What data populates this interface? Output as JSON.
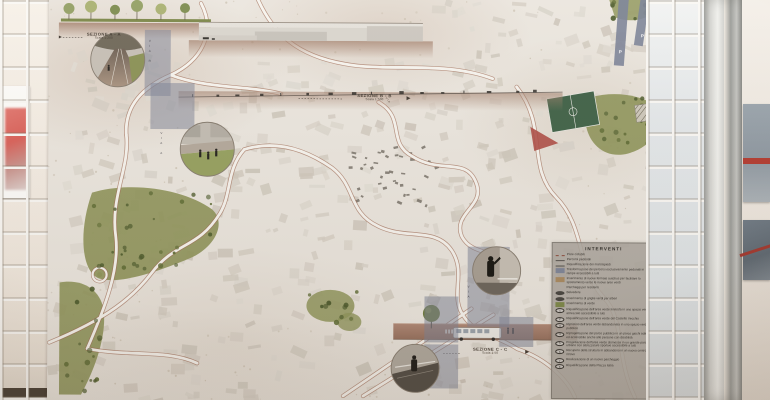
{
  "poster": {
    "sections": {
      "a": {
        "label": "SEZIONE A - A",
        "scale": "Scala 1:200"
      },
      "b": {
        "label": "SEZIONE B - B",
        "scale": "Scala 1:500"
      },
      "c": {
        "label": "SEZIONE C - C",
        "scale": "Scala 1:50"
      }
    },
    "legend": {
      "title": "INTERVENTI",
      "items": [
        {
          "sym": "dash",
          "text": "Piste ciclabili"
        },
        {
          "sym": "line",
          "text": "Percorsi pedonali"
        },
        {
          "sym": "line2",
          "text": "Riqualificazione dei marciapiedi"
        },
        {
          "sym": "sq",
          "text": "Trasformazione dei percorsi esclusivamente pedonali in rampe accessibili a tutti"
        },
        {
          "sym": "sq2",
          "text": "Inserimento di nuove fermate autobus per facilitare lo spostamento verso le nuove aree verdi"
        },
        {
          "sym": "p",
          "text": "Parcheggi per residenti"
        },
        {
          "sym": "dot",
          "text": "Belvedere"
        },
        {
          "sym": "dot",
          "text": "Inserimento di griglie verdi per alberi"
        },
        {
          "sym": "sqg",
          "text": "Inserimento di verde"
        },
        {
          "num": "1",
          "text": "Riqualificazione dell'area verde limitrofa in uno spazio verde attrezzato accessibile a tutti"
        },
        {
          "num": "2",
          "text": "Riqualificazione dell'area verde del Castello Vecchio"
        },
        {
          "num": "3",
          "text": "Ripristino dell'area verde abbandonata in uno spazio verde pubblico"
        },
        {
          "num": "4",
          "text": "Riprogettazione del parco pubblico in un parco giochi adatto ed accessibile anche alle persone con disabilità"
        },
        {
          "num": "5",
          "text": "Progettazione dell'area verde dismessa in un grande parco urbano con attrezzature sportive accessibile a tutti"
        },
        {
          "num": "6",
          "text": "Recupero della struttura in abbandono in un nuovo centro di ritrovo"
        },
        {
          "num": "7",
          "text": "Realizzazione di un nuovo parcheggio"
        },
        {
          "num": "8",
          "text": "Riqualificazione della Piazza Italia"
        }
      ]
    },
    "street_labels": [
      "VIA R",
      "VIA A",
      "VIA",
      "VIA"
    ],
    "parking_marks": [
      "P",
      "P"
    ],
    "colors": {
      "park_green": "#8f955a",
      "pitch_green": "#3f6146",
      "track_red": "#ad4a42",
      "overlay_slate": "#7d8497",
      "ground_brown": "#a3806c",
      "legend_bg": "#aba59d"
    }
  }
}
